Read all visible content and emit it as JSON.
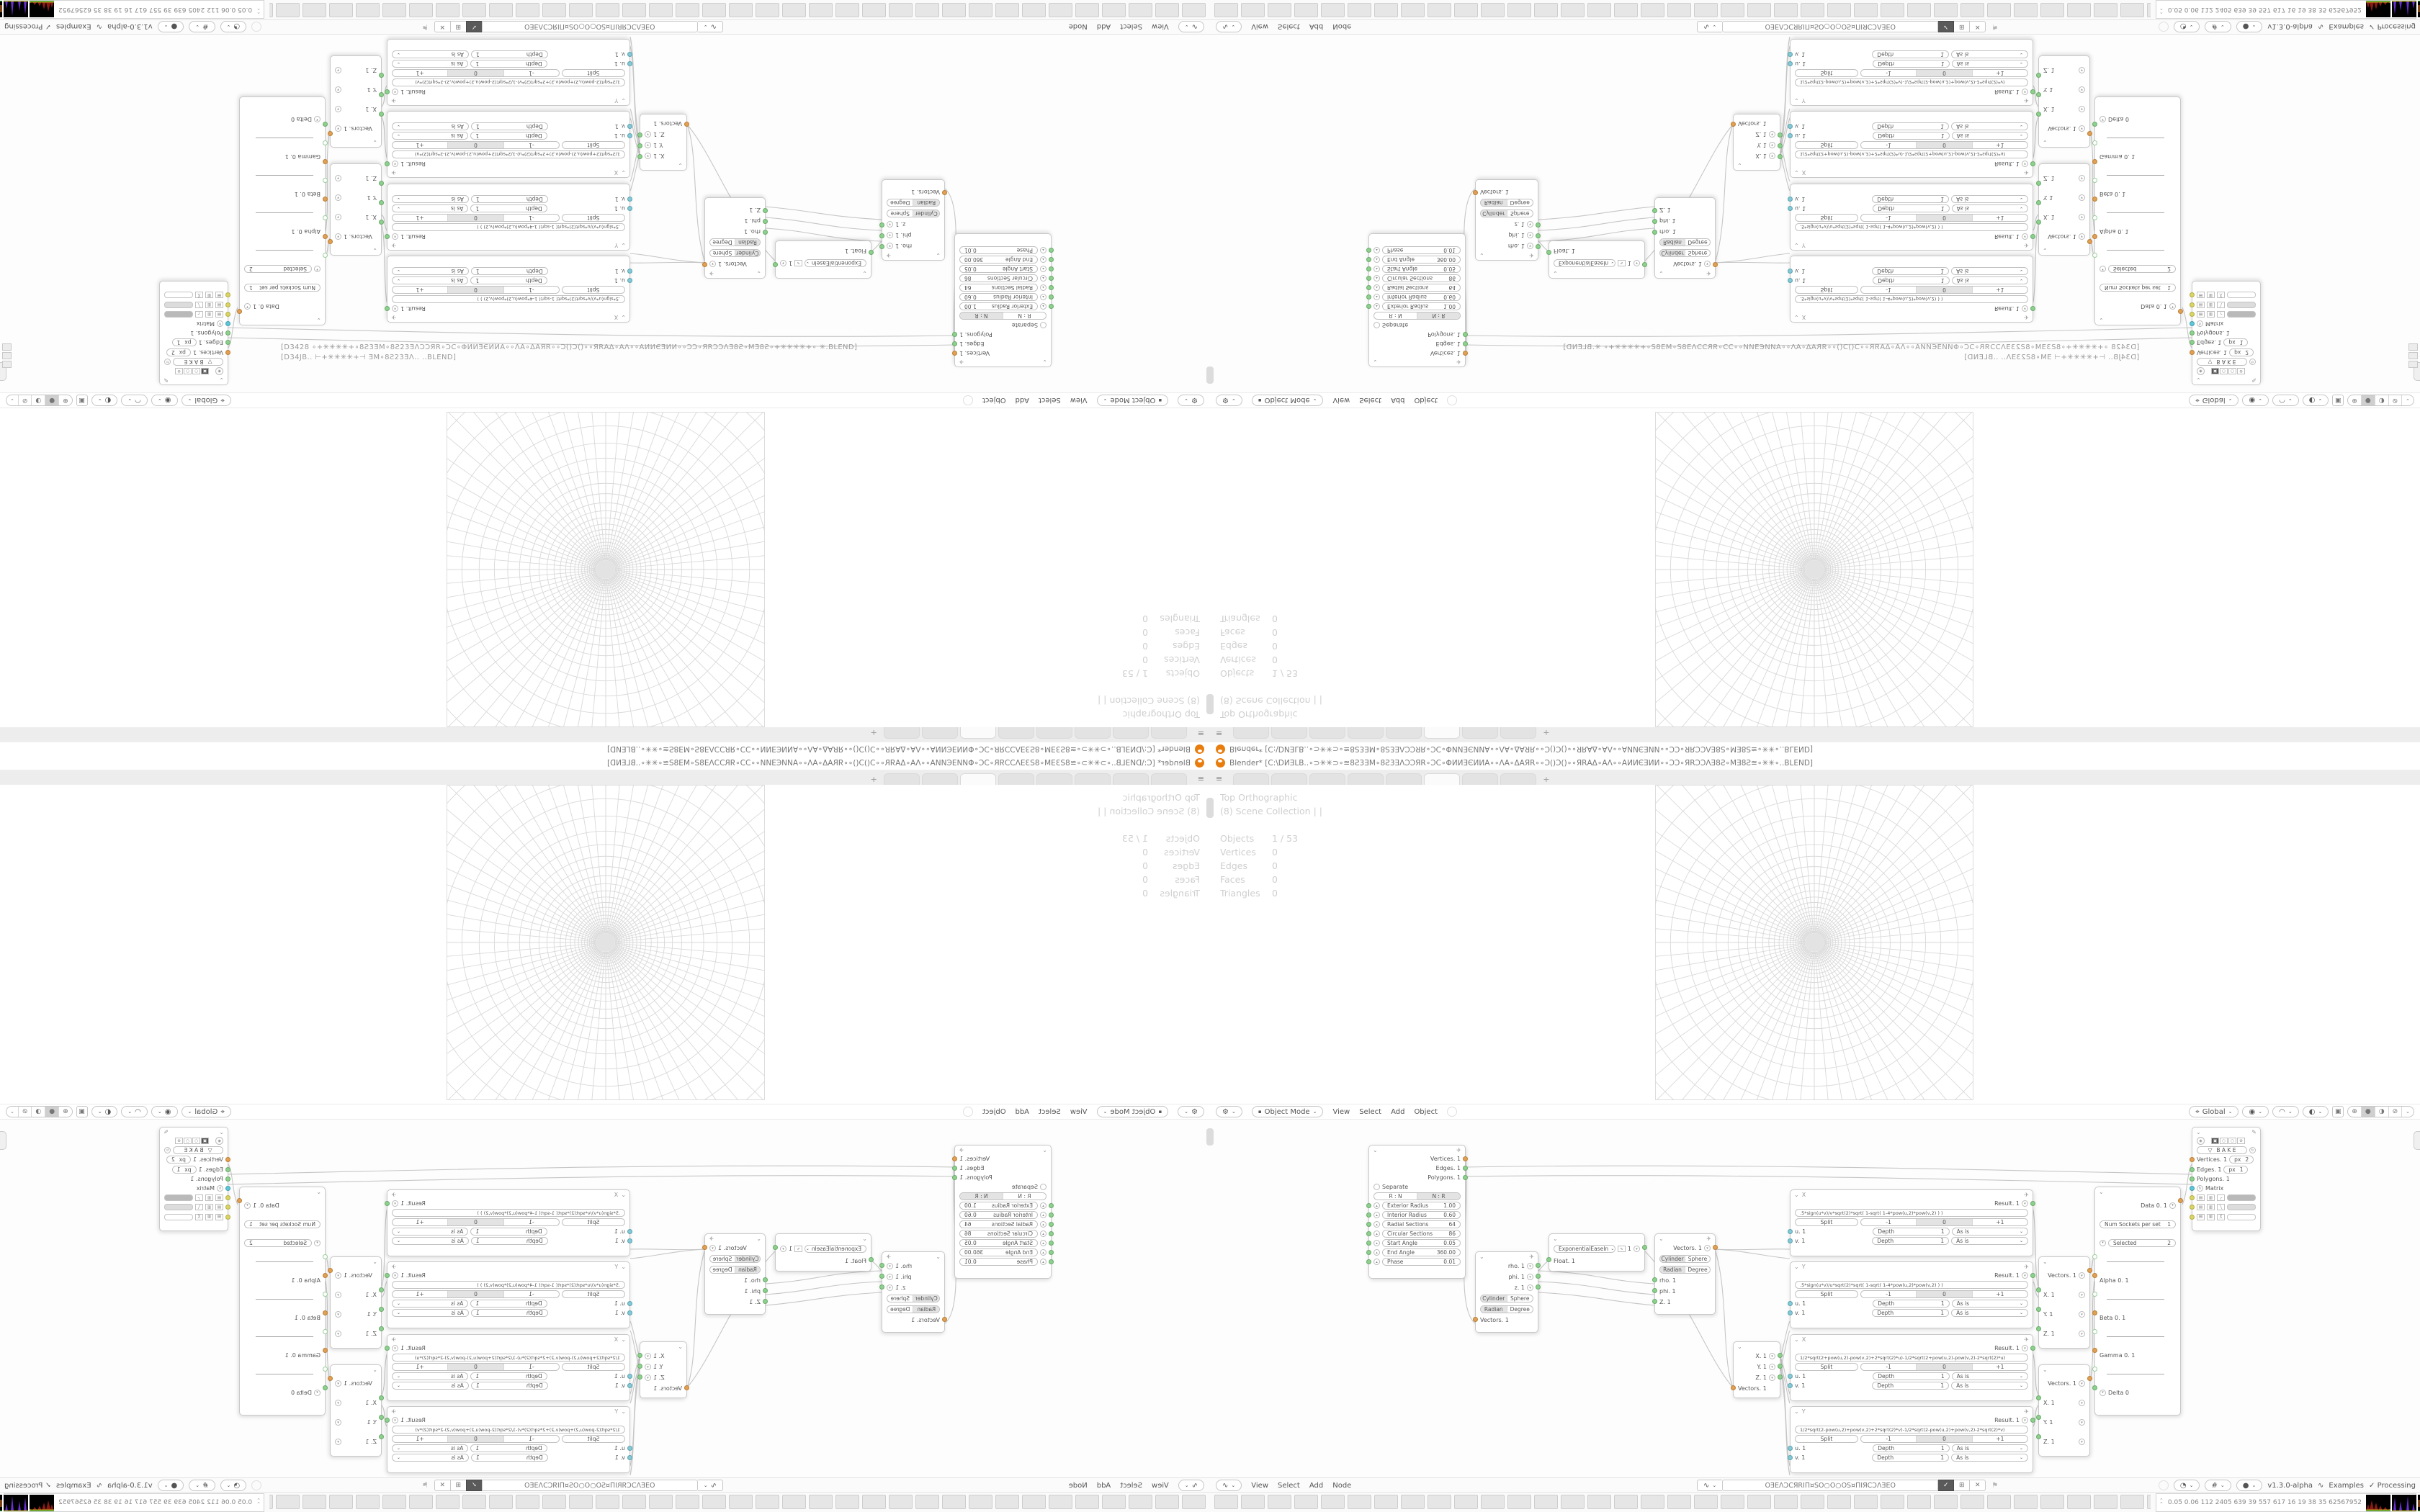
{
  "window": {
    "title": "Blender* [C:\\DИƎLB..∘⊃✳✳⊃∘≅8Ƨ3ƎМ∘8Ƨ3ƎΛƆƆЯR∘ƆC∘ΦИИƎЄИИΑ∘∘ΛΑ∘ΔΑЯR∘∘Ɔ()Ɔ()∘∘ЯRΑΔ∘ΑΛ∘∘ΑИИЄƎИИ∘∘ƆƆ∘ЯRƆƆΛƎ8Ƨ∘МƎ8Ƨ≅∘✳✳∘..BLEND]",
    "tabs": {
      "count": 8,
      "active_index": 5,
      "add_label": "+",
      "menu_icon": "≡"
    }
  },
  "viewport": {
    "view_label": "Top Orthographic",
    "collection_label": "(8) Scene Collection | |",
    "stats": [
      {
        "label": "Objects",
        "value": "1 / 53"
      },
      {
        "label": "Vertices",
        "value": "0"
      },
      {
        "label": "Edges",
        "value": "0"
      },
      {
        "label": "Faces",
        "value": "0"
      },
      {
        "label": "Triangles",
        "value": "0"
      }
    ],
    "footer": {
      "tool_icon": "⚙",
      "mode": "Object Mode",
      "menus": [
        "View",
        "Select",
        "Add",
        "Object"
      ],
      "orient_label": "Global",
      "shading_icons": [
        "⊕",
        "●",
        "◑",
        "⊘"
      ]
    }
  },
  "node_editor": {
    "header": {
      "editor_icon": "∿",
      "menus": [
        "View",
        "Select",
        "Add",
        "Node"
      ],
      "tree_name": "OƎEΛƆCЯRIΠ¤SO○O○OS¤ΠIЯCƆΛƎEO",
      "version": "v1.3.0-alpha",
      "dna_icon": "∿",
      "examples_label": "Examples",
      "processing_label": "Processing",
      "processing_check": "✓"
    },
    "nodes": {
      "ring": {
        "outputs": [
          "Vertices. 1",
          "Edges. 1",
          "Polygons. 1"
        ],
        "separate": "Separate",
        "mode": [
          "R : N",
          "N : R"
        ],
        "params": [
          {
            "label": "Exterior Radius",
            "value": "1.00"
          },
          {
            "label": "Interior Radius",
            "value": "0.60"
          },
          {
            "label": "Radial Sections",
            "value": "64"
          },
          {
            "label": "Circular Sections",
            "value": "86"
          },
          {
            "label": "Start Angle",
            "value": "0.05"
          },
          {
            "label": "End Angle",
            "value": "360.00"
          },
          {
            "label": "Phase",
            "value": "0.01"
          }
        ]
      },
      "polar_out": {
        "outputs": [
          "rho. 1",
          "phi. 1",
          "z. 1"
        ],
        "toggle1": [
          "Cylinder",
          "Sphere"
        ],
        "toggle2": [
          "Radian",
          "Degree"
        ],
        "input": "Vectors. 1"
      },
      "ease": {
        "mode": "ExponentialEaseIn",
        "value": "1",
        "input": "Float. 1"
      },
      "polar_in": {
        "output": "Vectors. 1",
        "toggle1": [
          "Cylinder",
          "Sphere"
        ],
        "toggle2": [
          "Radian",
          "Degree"
        ],
        "inputs": [
          "rho. 1",
          "phi. 1",
          "Z. 1"
        ]
      },
      "vector_split": {
        "outputs": [
          "X. 1",
          "Y. 1",
          "Z. 1"
        ],
        "input": "Vectors. 1"
      },
      "formula_common": {
        "result": "Result. 1",
        "split": "Split",
        "minus": "-1",
        "zero": "0",
        "plus": "+1",
        "u": "u. 1",
        "v": "v. 1",
        "depth": "Depth",
        "depth_value": "1",
        "wrap": "As is"
      },
      "formulas": [
        {
          "title": "X",
          "expr": ".5*sign(u*v)/v*sqrt(2)*sqrt(   1-sqrt(   1-4*pow(u,2)*pow(v,2)   )   )"
        },
        {
          "title": "Y",
          "expr": ".5*sign(u*v)/u*sqrt(2)*sqrt(   1-sqrt(   1-4*pow(u,2)*pow(v,2)   )   )"
        },
        {
          "title": "X",
          "expr": "1/2*sqrt(2+pow(u,2)-pow(v,2)+2*sqrt(2)*u)-1/2*sqrt(2+pow(u,2)-pow(v,2)-2*sqrt(2)*u)"
        },
        {
          "title": "Y",
          "expr": "1/2*sqrt(2-pow(u,2)+pow(v,2)+2*sqrt(2)*v)-1/2*sqrt(2-pow(u,2)+pow(v,2)-2*sqrt(2)*v)"
        }
      ],
      "vector1": {
        "output": "Vectors. 1",
        "inputs": [
          "X. 1",
          "Y. 1",
          "Z. 1"
        ]
      },
      "vector2": {
        "output": "Vectors. 1",
        "inputs": [
          "X. 1",
          "Y. 1",
          "Z. 1"
        ]
      },
      "data": {
        "output": "Data 0. 1",
        "num_sockets": {
          "label": "Num Sockets per set",
          "value": "1"
        },
        "selected": {
          "label": "Selected",
          "value": "2"
        },
        "dash": "————",
        "greek": [
          "Alpha 0. 1",
          "Beta 0. 1",
          "Gamma 0. 1",
          "Delta 0"
        ]
      },
      "viewer": {
        "bake": "B A K E",
        "rows": [
          {
            "label": "Vertices. 1",
            "px": "px",
            "value": "2"
          },
          {
            "label": "Edges. 1",
            "px": "px",
            "value": "1"
          },
          {
            "label": "Polygons. 1"
          },
          {
            "label": "Matrix"
          }
        ]
      }
    }
  },
  "taskbar": {
    "button_count": 36,
    "monitor": {
      "chevrons": "⌃⌃",
      "numbers": "0.05 0.06 112 2405 639   39   557   617   16   19   38   35  62567952"
    }
  },
  "console_overlay": {
    "line1": "[D3428  ∘+✳✳✳✳+∘8Ƨ3ƎМ∘8Ƨ23ƎΛƆƆЯR∘ƆC∘ΦИИƎЄИИΑ∘∘ΛΑ∘ΔΑЯR∘∘Ɔ()Ɔ()∘∘ЯRΑΔ∘ΑΛ∘∘ΑИИЄƎИИ∘∘ƆƆ∘ЯRƆƆΛƎ8Ƨ∘МƎ8Ƨ∘+✳✳✳✳+∘  ✳.BLEND]",
    "line2": "[D34ЈB..   ⊢+✳✳✳✳+⊣   ƎМ∘8Ƨ23ƎΛ..                                        ..BLEND]"
  }
}
